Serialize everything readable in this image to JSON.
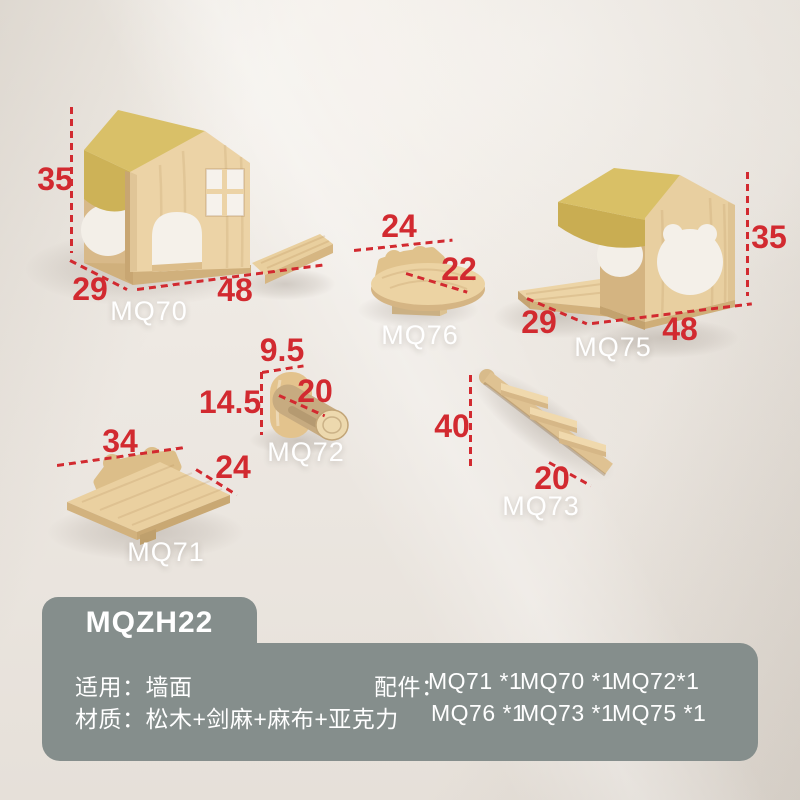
{
  "colors": {
    "dimension_red": "#d22a30",
    "label_white": "#ffffff",
    "panel_sage": "#858e8c",
    "wood_light": "#ecd3a6",
    "wood_mid": "#e0c28e",
    "wood_dark": "#c9a671",
    "fabric_yellow": "#d8bf66",
    "wall_background": "#ece7e1"
  },
  "products": [
    {
      "code": "MQ70",
      "dimensions": [
        "35",
        "29",
        "48"
      ]
    },
    {
      "code": "MQ76",
      "dimensions": [
        "24",
        "22"
      ]
    },
    {
      "code": "MQ75",
      "dimensions": [
        "35",
        "29",
        "48"
      ]
    },
    {
      "code": "MQ72",
      "dimensions": [
        "9.5",
        "14.5",
        "20"
      ]
    },
    {
      "code": "MQ71",
      "dimensions": [
        "34",
        "24"
      ]
    },
    {
      "code": "MQ73",
      "dimensions": [
        "40",
        "20"
      ]
    }
  ],
  "info_panel": {
    "model": "MQZH22",
    "usage_label": "适用：",
    "usage_value": "墙面",
    "material_label": "材质：",
    "material_value": "松木+剑麻+麻布+亚克力",
    "accessories_label": "配件：",
    "accessories_row1": [
      "MQ71 *1",
      "MQ70 *1",
      "MQ72*1"
    ],
    "accessories_row2": [
      "MQ76 *1",
      "MQ73 *1",
      "MQ75 *1"
    ]
  }
}
